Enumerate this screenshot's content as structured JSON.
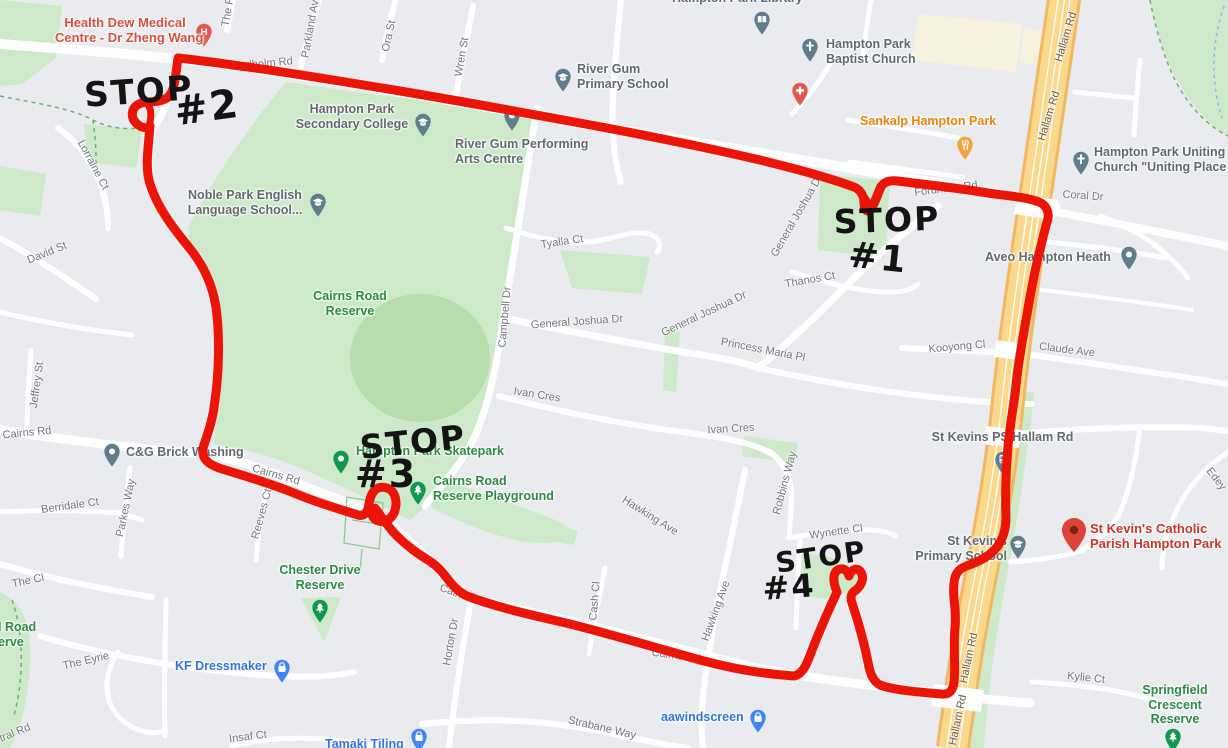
{
  "app": "map-screenshot",
  "colors": {
    "background": "#e9ebee",
    "park_green": "#cde9c9",
    "park_dark": "#b7ddad",
    "road_white": "#ffffff",
    "highway_fill": "#fbd88b",
    "highway_edge": "#f1b863",
    "route_red": "#ea1507",
    "handwriting": "#141414",
    "street_label": "#73777c",
    "poi_gray": "#636a6f",
    "poi_green": "#2e8b44",
    "poi_blue": "#3374e0",
    "poi_red": "#d14836",
    "poi_orange": "#e8840c"
  },
  "route": {
    "color": "#ea1507",
    "stops": [
      "STOP #1",
      "STOP #2",
      "STOP #3",
      "STOP #4"
    ]
  },
  "handwritten": [
    {
      "t": "STOP",
      "x": 139,
      "y": 92,
      "s": 34,
      "r": -4
    },
    {
      "t": "#2",
      "x": 207,
      "y": 108,
      "s": 40,
      "r": -8
    },
    {
      "t": "STOP",
      "x": 887,
      "y": 220,
      "s": 33,
      "r": -2
    },
    {
      "t": "#1",
      "x": 878,
      "y": 258,
      "s": 36,
      "r": 6
    },
    {
      "t": "STOP",
      "x": 413,
      "y": 442,
      "s": 33,
      "r": -6
    },
    {
      "t": "#3",
      "x": 386,
      "y": 474,
      "s": 38,
      "r": 0
    },
    {
      "t": "STOP",
      "x": 821,
      "y": 557,
      "s": 28,
      "r": -8
    },
    {
      "t": "#4",
      "x": 789,
      "y": 587,
      "s": 32,
      "r": -4
    }
  ],
  "street_labels": [
    {
      "t": "Fordholm Rd",
      "x": 261,
      "y": 64,
      "r": -5
    },
    {
      "t": "Fordholm Rd",
      "x": 946,
      "y": 189,
      "r": -7
    },
    {
      "t": "The P",
      "x": 228,
      "y": 12,
      "r": -80
    },
    {
      "t": "Parkland Ave",
      "x": 311,
      "y": 26,
      "r": -80
    },
    {
      "t": "Ora St",
      "x": 389,
      "y": 36,
      "r": -78
    },
    {
      "t": "Wren St",
      "x": 462,
      "y": 57,
      "r": -80
    },
    {
      "t": "Lorraine Ct",
      "x": 93,
      "y": 165,
      "r": 62
    },
    {
      "t": "David St",
      "x": 47,
      "y": 253,
      "r": -22
    },
    {
      "t": "Jeffrey St",
      "x": 37,
      "y": 385,
      "r": -82
    },
    {
      "t": "Cairns Rd",
      "x": 27,
      "y": 433,
      "r": -6
    },
    {
      "t": "Cairns Rd",
      "x": 276,
      "y": 475,
      "r": 16
    },
    {
      "t": "Berridale Ct",
      "x": 70,
      "y": 506,
      "r": -8
    },
    {
      "t": "Parkes Way",
      "x": 126,
      "y": 508,
      "r": -78
    },
    {
      "t": "Reeves Ct",
      "x": 262,
      "y": 514,
      "r": -75
    },
    {
      "t": "The Cl",
      "x": 28,
      "y": 581,
      "r": -12
    },
    {
      "t": "The Eyrie",
      "x": 86,
      "y": 661,
      "r": -13
    },
    {
      "t": "tral Rd",
      "x": 15,
      "y": 733,
      "r": -22
    },
    {
      "t": "Insaf Ct",
      "x": 248,
      "y": 737,
      "r": -7
    },
    {
      "t": "Horton Dr",
      "x": 451,
      "y": 642,
      "r": -80
    },
    {
      "t": "Cash Cl",
      "x": 595,
      "y": 601,
      "r": -85
    },
    {
      "t": "Cairns Rd",
      "x": 463,
      "y": 596,
      "r": 20
    },
    {
      "t": "Cairns Rd",
      "x": 676,
      "y": 656,
      "r": 8
    },
    {
      "t": "Hawking Ave",
      "x": 650,
      "y": 516,
      "r": 32
    },
    {
      "t": "Hawking Ave",
      "x": 716,
      "y": 611,
      "r": -70
    },
    {
      "t": "Robbins Way",
      "x": 785,
      "y": 483,
      "r": -75
    },
    {
      "t": "Wynette Cl",
      "x": 836,
      "y": 532,
      "r": -8
    },
    {
      "t": "Strabane Way",
      "x": 602,
      "y": 728,
      "r": 13
    },
    {
      "t": "Tyalla Ct",
      "x": 562,
      "y": 242,
      "r": -8
    },
    {
      "t": "Campbell Dr",
      "x": 505,
      "y": 317,
      "r": -85
    },
    {
      "t": "General Joshua Dr",
      "x": 577,
      "y": 322,
      "r": -4
    },
    {
      "t": "General Joshua Dr",
      "x": 704,
      "y": 314,
      "r": -25
    },
    {
      "t": "General Joshua Dr",
      "x": 797,
      "y": 216,
      "r": -60
    },
    {
      "t": "Thanos Ct",
      "x": 810,
      "y": 280,
      "r": -10
    },
    {
      "t": "Princess Maria Pl",
      "x": 763,
      "y": 350,
      "r": 11
    },
    {
      "t": "Ivan Cres",
      "x": 537,
      "y": 395,
      "r": 9
    },
    {
      "t": "Ivan Cres",
      "x": 731,
      "y": 429,
      "r": -3
    },
    {
      "t": "Kooyong Cl",
      "x": 957,
      "y": 347,
      "r": -5
    },
    {
      "t": "Claude Ave",
      "x": 1067,
      "y": 350,
      "r": 7
    },
    {
      "t": "Coral Dr",
      "x": 1083,
      "y": 196,
      "r": 4
    },
    {
      "t": "Edey",
      "x": 1216,
      "y": 479,
      "r": 52
    },
    {
      "t": "Kylie Ct",
      "x": 1086,
      "y": 678,
      "r": 6
    },
    {
      "t": "Hallam Rd",
      "x": 1066,
      "y": 37,
      "r": -73,
      "c": "#6b5d49"
    },
    {
      "t": "Hallam Rd",
      "x": 1049,
      "y": 116,
      "r": -73,
      "c": "#6b5d49"
    },
    {
      "t": "Hallam Rd",
      "x": 969,
      "y": 658,
      "r": -78,
      "c": "#6b5d49"
    },
    {
      "t": "Hallam Rd",
      "x": 958,
      "y": 720,
      "r": -78,
      "c": "#6b5d49"
    }
  ],
  "places": [
    {
      "id": "health-dew-medical",
      "lines": [
        "Health Dew Medical",
        "Centre - Dr Zheng Wang"
      ],
      "color": "#d94f3d",
      "lx": 55,
      "ly": 15,
      "lw": 140,
      "align": "center",
      "fs": 13,
      "pin": {
        "x": 204,
        "y": 48,
        "color": "#e05a4e",
        "icon": "h"
      }
    },
    {
      "id": "river-gum-primary-school",
      "lines": [
        "River Gum",
        "Primary School"
      ],
      "color": "#636a6f",
      "lx": 577,
      "ly": 62,
      "align": "left",
      "pin": {
        "x": 563,
        "y": 93,
        "color": "#5f7d8c",
        "icon": "cap"
      }
    },
    {
      "id": "hampton-park-secondary-college",
      "lines": [
        "Hampton Park",
        "Secondary College"
      ],
      "color": "#636a6f",
      "lx": 290,
      "ly": 102,
      "lw": 124,
      "align": "center",
      "pin": {
        "x": 423,
        "y": 138,
        "color": "#5f7d8c",
        "icon": "cap"
      }
    },
    {
      "id": "river-gum-performing-arts",
      "lines": [
        "River Gum Performing",
        "Arts Centre"
      ],
      "color": "#636a6f",
      "lx": 455,
      "ly": 137,
      "align": "left",
      "pin": {
        "x": 512,
        "y": 132,
        "color": "#5f7d8c",
        "icon": "dot"
      }
    },
    {
      "id": "hampton-park-library",
      "lines": [
        "Hampton Park Library"
      ],
      "color": "#636a6f",
      "lx": 672,
      "ly": -9,
      "align": "left",
      "pin": {
        "x": 762,
        "y": 36,
        "color": "#5f7d8c",
        "icon": "book"
      }
    },
    {
      "id": "hampton-park-baptist-church",
      "lines": [
        "Hampton Park",
        "Baptist Church"
      ],
      "color": "#636a6f",
      "lx": 826,
      "ly": 37,
      "align": "left",
      "pin": {
        "x": 810,
        "y": 63,
        "color": "#5f7d8c",
        "icon": "cross"
      }
    },
    {
      "id": "medical-marker",
      "lines": [],
      "pin": {
        "x": 800,
        "y": 107,
        "color": "#e05a4e",
        "icon": "plus"
      }
    },
    {
      "id": "sankalp-hampton-park",
      "lines": [
        "Sankalp Hampton Park"
      ],
      "color": "#e8840c",
      "lx": 860,
      "ly": 114,
      "align": "left",
      "pin": {
        "x": 965,
        "y": 161,
        "color": "#f2a33c",
        "icon": "fork"
      }
    },
    {
      "id": "hampton-park-uniting-church",
      "lines": [
        "Hampton Park Uniting",
        "Church \"Uniting Place"
      ],
      "color": "#636a6f",
      "lx": 1094,
      "ly": 145,
      "align": "left",
      "pin": {
        "x": 1081,
        "y": 176,
        "color": "#5f7d8c",
        "icon": "cross"
      }
    },
    {
      "id": "aveo-hampton-heath",
      "lines": [
        "Aveo Hampton Heath"
      ],
      "color": "#636a6f",
      "lx": 985,
      "ly": 250,
      "align": "left",
      "pin": {
        "x": 1129,
        "y": 271,
        "color": "#5f7d8c",
        "icon": "dot"
      }
    },
    {
      "id": "cairns-road-reserve",
      "lines": [
        "Cairns Road",
        "Reserve"
      ],
      "color": "#2e8b44",
      "lx": 305,
      "ly": 289,
      "lw": 90,
      "align": "center"
    },
    {
      "id": "cg-brick-washing",
      "lines": [
        "C&G Brick Washing"
      ],
      "color": "#636a6f",
      "lx": 126,
      "ly": 445,
      "align": "left",
      "pin": {
        "x": 112,
        "y": 468,
        "color": "#5f7d8c",
        "icon": "dot"
      }
    },
    {
      "id": "hampton-park-skatepark",
      "lines": [
        "Hampton Park Skatepark"
      ],
      "color": "#2e8b44",
      "lx": 356,
      "ly": 444,
      "align": "left",
      "pin": {
        "x": 341,
        "y": 475,
        "color": "#12984e",
        "icon": "dot"
      }
    },
    {
      "id": "cairns-road-reserve-playground",
      "lines": [
        "Cairns Road",
        "Reserve Playground"
      ],
      "color": "#2e8b44",
      "lx": 433,
      "ly": 474,
      "align": "left",
      "pin": {
        "x": 418,
        "y": 506,
        "color": "#12984e",
        "icon": "tree"
      }
    },
    {
      "id": "chester-drive-reserve",
      "lines": [
        "Chester Drive",
        "Reserve"
      ],
      "color": "#2e8b44",
      "lx": 272,
      "ly": 563,
      "lw": 96,
      "align": "center",
      "pin": {
        "x": 320,
        "y": 624,
        "color": "#12984e",
        "icon": "tree"
      }
    },
    {
      "id": "kf-dressmaker",
      "lines": [
        "KF Dressmaker"
      ],
      "color": "#3374e0",
      "lx": 175,
      "ly": 659,
      "align": "left",
      "pin": {
        "x": 282,
        "y": 684,
        "color": "#4285f4",
        "icon": "bag"
      }
    },
    {
      "id": "tamaki-tiling",
      "lines": [
        "Tamaki Tiling"
      ],
      "color": "#3374e0",
      "lx": 325,
      "ly": 737,
      "align": "left",
      "pin": {
        "x": 419,
        "y": 753,
        "color": "#4285f4",
        "icon": "bag"
      }
    },
    {
      "id": "aawindscreen",
      "lines": [
        "aawindscreen"
      ],
      "color": "#3374e0",
      "lx": 661,
      "ly": 710,
      "align": "left",
      "pin": {
        "x": 758,
        "y": 734,
        "color": "#4285f4",
        "icon": "bag"
      }
    },
    {
      "id": "st-kevins-ps-hallam-rd",
      "lines": [
        "St Kevins PS/Hallam Rd"
      ],
      "color": "#636a6f",
      "lx": 925,
      "ly": 430,
      "lw": 155,
      "align": "center",
      "pin": {
        "x": 1003,
        "y": 476,
        "color": "#5f7d8c",
        "icon": "bus"
      }
    },
    {
      "id": "st-kevins-primary-school",
      "lines": [
        "St Kevin's",
        "Primary School"
      ],
      "color": "#636a6f",
      "lx": 903,
      "ly": 534,
      "lw": 104,
      "align": "right",
      "pin": {
        "x": 1018,
        "y": 560,
        "color": "#5f7d8c",
        "icon": "cap"
      }
    },
    {
      "id": "st-kevins-catholic-parish",
      "lines": [
        "St Kevin's Catholic",
        "Parish Hampton Park"
      ],
      "color": "#c5392b",
      "lx": 1090,
      "ly": 521,
      "align": "left",
      "fs": 13,
      "pin": {
        "x": 1074,
        "y": 553,
        "color": "#db4437",
        "icon": "red-pin"
      }
    },
    {
      "id": "springfield-crescent-reserve",
      "lines": [
        "Springfield",
        "Crescent",
        "Reserve"
      ],
      "color": "#2e8b44",
      "lx": 1135,
      "ly": 683,
      "lw": 80,
      "align": "center",
      "pin": {
        "x": 1173,
        "y": 753,
        "color": "#12984e",
        "icon": "tree"
      }
    },
    {
      "id": "noble-park-english-language-school",
      "lines": [
        "Noble Park English",
        "Language School..."
      ],
      "color": "#636a6f",
      "lx": 182,
      "ly": 188,
      "lw": 126,
      "align": "center",
      "pin": {
        "x": 318,
        "y": 218,
        "color": "#5f7d8c",
        "icon": "cap"
      }
    },
    {
      "id": "road-reserve-partial",
      "lines": [
        "l Road",
        "erve"
      ],
      "color": "#2e8b44",
      "lx": -2,
      "ly": 620,
      "align": "left"
    }
  ]
}
